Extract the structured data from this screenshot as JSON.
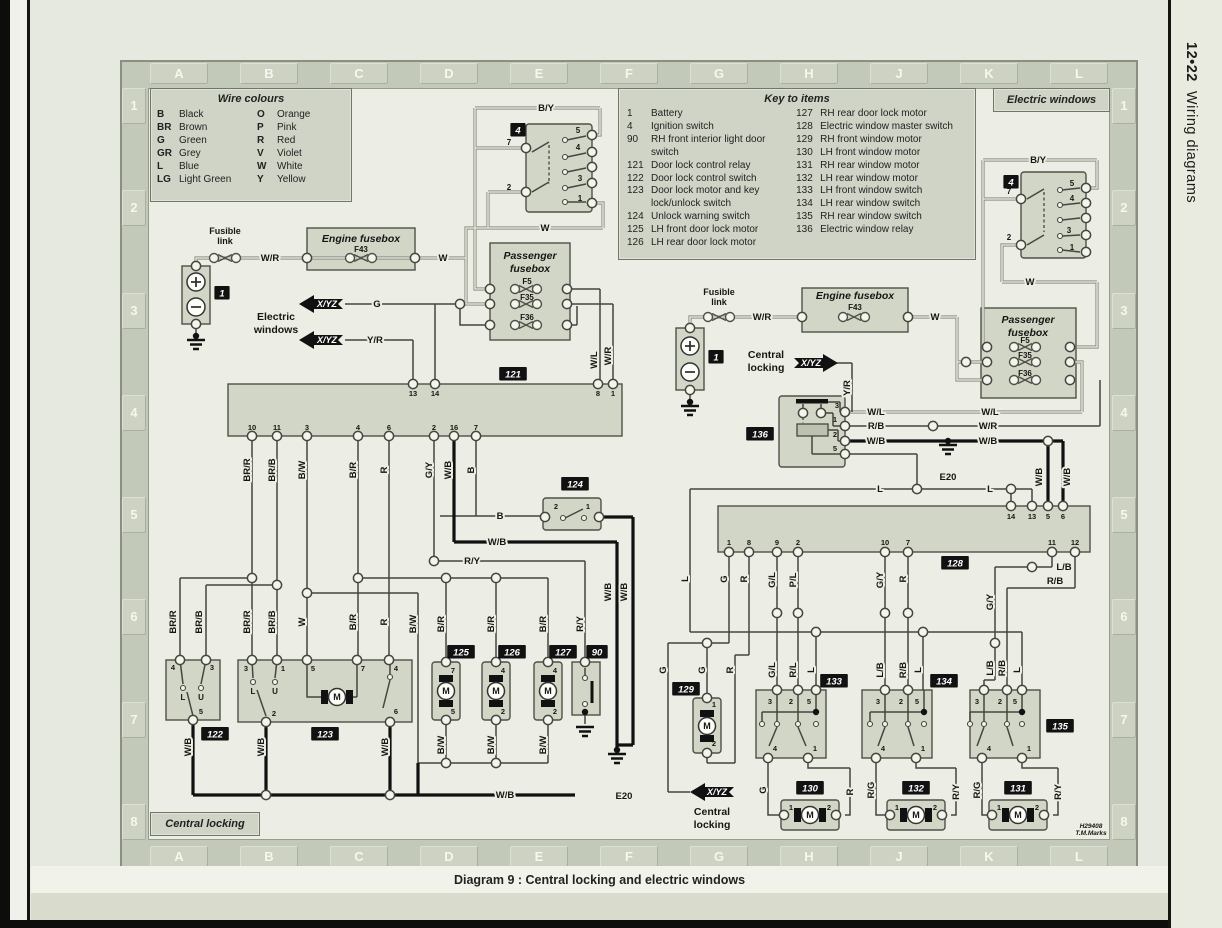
{
  "page": {
    "sidebar_page": "12•22",
    "sidebar_title": "Wiring diagrams",
    "caption": "Diagram 9 : Central locking and electric windows",
    "grid_letters": [
      "A",
      "B",
      "C",
      "D",
      "E",
      "F",
      "G",
      "H",
      "J",
      "K",
      "L"
    ],
    "grid_numbers": [
      "1",
      "2",
      "3",
      "4",
      "5",
      "6",
      "7",
      "8"
    ]
  },
  "tags": {
    "electric_windows": "Electric windows",
    "central_locking": "Central locking"
  },
  "wire_colours": {
    "title": "Wire colours",
    "entries": [
      {
        "c": "B",
        "n": "Black"
      },
      {
        "c": "O",
        "n": "Orange"
      },
      {
        "c": "BR",
        "n": "Brown"
      },
      {
        "c": "P",
        "n": "Pink"
      },
      {
        "c": "G",
        "n": "Green"
      },
      {
        "c": "R",
        "n": "Red"
      },
      {
        "c": "GR",
        "n": "Grey"
      },
      {
        "c": "V",
        "n": "Violet"
      },
      {
        "c": "L",
        "n": "Blue"
      },
      {
        "c": "W",
        "n": "White"
      },
      {
        "c": "LG",
        "n": "Light Green"
      },
      {
        "c": "Y",
        "n": "Yellow"
      }
    ]
  },
  "key_to_items": {
    "title": "Key to items",
    "left": [
      {
        "num": "1",
        "label": "Battery"
      },
      {
        "num": "4",
        "label": "Ignition switch"
      },
      {
        "num": "90",
        "label": "RH front interior light door switch"
      },
      {
        "num": "121",
        "label": "Door lock control relay"
      },
      {
        "num": "122",
        "label": "Door lock control switch"
      },
      {
        "num": "123",
        "label": "Door lock motor and key lock/unlock switch"
      },
      {
        "num": "124",
        "label": "Unlock warning switch"
      },
      {
        "num": "125",
        "label": "LH front door lock motor"
      },
      {
        "num": "126",
        "label": "LH rear door lock motor"
      }
    ],
    "right": [
      {
        "num": "127",
        "label": "RH rear door lock motor"
      },
      {
        "num": "128",
        "label": "Electric window master switch"
      },
      {
        "num": "129",
        "label": "RH front window motor"
      },
      {
        "num": "130",
        "label": "LH front window motor"
      },
      {
        "num": "131",
        "label": "RH rear window motor"
      },
      {
        "num": "132",
        "label": "LH rear window motor"
      },
      {
        "num": "133",
        "label": "LH front window switch"
      },
      {
        "num": "134",
        "label": "LH rear window switch"
      },
      {
        "num": "135",
        "label": "RH rear window switch"
      },
      {
        "num": "136",
        "label": "Electric window relay"
      }
    ]
  },
  "colors": {
    "badge_bg": "#111111",
    "wire_dark": "#3f413b",
    "inner_bg": "#ecede4",
    "box_fill": "#d2d6c6"
  },
  "svg": {
    "labels": [
      [
        546,
        111,
        "B/Y",
        "h"
      ],
      [
        545,
        231,
        "W",
        "h"
      ],
      [
        509,
        145,
        "7",
        "s8"
      ],
      [
        509,
        190,
        "2",
        "s8"
      ],
      [
        578,
        133,
        "5",
        "s8"
      ],
      [
        578,
        150,
        "4",
        "s8"
      ],
      [
        580,
        181,
        "3",
        "s8"
      ],
      [
        580,
        201,
        "1",
        "s8"
      ],
      [
        225,
        234,
        "Fusible",
        "s9"
      ],
      [
        225,
        244,
        "link",
        "s9"
      ],
      [
        270,
        261,
        "W/R",
        "h"
      ],
      [
        361,
        242,
        "Engine fusebox",
        "i10.5"
      ],
      [
        361,
        252,
        "F43",
        "s8"
      ],
      [
        443,
        261,
        "W",
        "h"
      ],
      [
        276,
        320,
        "Electric",
        "s10.5"
      ],
      [
        276,
        333,
        "windows",
        "s10.5"
      ],
      [
        327,
        307,
        "X/YZ",
        "wi9"
      ],
      [
        327,
        343,
        "X/YZ",
        "wi9"
      ],
      [
        377,
        307,
        "G",
        "h"
      ],
      [
        375,
        343,
        "Y/R",
        "h"
      ],
      [
        530,
        259,
        "Passenger",
        "i10.5"
      ],
      [
        530,
        272,
        "fusebox",
        "i10.5"
      ],
      [
        527,
        284,
        "F5",
        "s8"
      ],
      [
        527,
        300,
        "F35",
        "s8"
      ],
      [
        527,
        320,
        "F36",
        "s8"
      ],
      [
        597,
        360,
        "W/L",
        "rh"
      ],
      [
        611,
        356,
        "W/R",
        "rh"
      ],
      [
        413,
        396,
        "13",
        "s7.5"
      ],
      [
        435,
        396,
        "14",
        "s7.5"
      ],
      [
        598,
        396,
        "8",
        "s7.5"
      ],
      [
        613,
        396,
        "1",
        "s7.5"
      ],
      [
        252,
        430,
        "10",
        "s7.5"
      ],
      [
        277,
        430,
        "11",
        "s7.5"
      ],
      [
        307,
        430,
        "3",
        "s7.5"
      ],
      [
        358,
        430,
        "4",
        "s7.5"
      ],
      [
        389,
        430,
        "6",
        "s7.5"
      ],
      [
        434,
        430,
        "2",
        "s7.5"
      ],
      [
        454,
        430,
        "16",
        "s7.5"
      ],
      [
        476,
        430,
        "7",
        "s7.5"
      ],
      [
        250,
        470,
        "BR/R",
        "rh"
      ],
      [
        275,
        470,
        "BR/B",
        "rh"
      ],
      [
        305,
        470,
        "B/W",
        "rh"
      ],
      [
        356,
        470,
        "B/R",
        "rh"
      ],
      [
        387,
        470,
        "R",
        "rh"
      ],
      [
        432,
        470,
        "G/Y",
        "rh"
      ],
      [
        451,
        470,
        "W/B",
        "rh"
      ],
      [
        474,
        470,
        "B",
        "rh"
      ],
      [
        556,
        509,
        "2",
        "s7.5"
      ],
      [
        588,
        509,
        "1",
        "s7.5"
      ],
      [
        500,
        519,
        "B",
        "h"
      ],
      [
        497,
        545,
        "W/B",
        "h"
      ],
      [
        472,
        564,
        "R/Y",
        "h"
      ],
      [
        611,
        592,
        "W/B",
        "rh"
      ],
      [
        627,
        592,
        "W/B",
        "rh"
      ],
      [
        176,
        622,
        "BR/R",
        "rh"
      ],
      [
        202,
        622,
        "BR/B",
        "rh"
      ],
      [
        250,
        622,
        "BR/R",
        "rh"
      ],
      [
        275,
        622,
        "BR/B",
        "rh"
      ],
      [
        305,
        622,
        "W",
        "rh"
      ],
      [
        356,
        622,
        "B/R",
        "rh"
      ],
      [
        387,
        622,
        "R",
        "rh"
      ],
      [
        416,
        624,
        "B/W",
        "rh"
      ],
      [
        444,
        624,
        "B/R",
        "rh"
      ],
      [
        494,
        624,
        "B/R",
        "rh"
      ],
      [
        546,
        624,
        "B/R",
        "rh"
      ],
      [
        583,
        624,
        "R/Y",
        "rh"
      ],
      [
        173,
        670,
        "4",
        "s7.5"
      ],
      [
        212,
        670,
        "3",
        "s7.5"
      ],
      [
        183,
        700,
        "L",
        "s8"
      ],
      [
        201,
        700,
        "U",
        "s8"
      ],
      [
        201,
        714,
        "5",
        "s7.5"
      ],
      [
        191,
        747,
        "W/B",
        "rh"
      ],
      [
        246,
        671,
        "3",
        "s7.5"
      ],
      [
        283,
        671,
        "1",
        "s7.5"
      ],
      [
        313,
        671,
        "5",
        "s7.5"
      ],
      [
        363,
        671,
        "7",
        "s7.5"
      ],
      [
        396,
        671,
        "4",
        "s7.5"
      ],
      [
        253,
        694,
        "L",
        "s8"
      ],
      [
        275,
        694,
        "U",
        "s8"
      ],
      [
        274,
        716,
        "2",
        "s7.5"
      ],
      [
        337,
        700,
        "M",
        "s9"
      ],
      [
        396,
        714,
        "6",
        "s7.5"
      ],
      [
        264,
        747,
        "W/B",
        "rh"
      ],
      [
        388,
        747,
        "W/B",
        "rh"
      ],
      [
        453,
        673,
        "7",
        "s7.5"
      ],
      [
        453,
        714,
        "5",
        "s7.5"
      ],
      [
        446,
        694,
        "M",
        "s9"
      ],
      [
        503,
        673,
        "4",
        "s7.5"
      ],
      [
        503,
        714,
        "2",
        "s7.5"
      ],
      [
        496,
        694,
        "M",
        "s9"
      ],
      [
        555,
        673,
        "4",
        "s7.5"
      ],
      [
        555,
        714,
        "2",
        "s7.5"
      ],
      [
        548,
        694,
        "M",
        "s9"
      ],
      [
        444,
        745,
        "B/W",
        "rh"
      ],
      [
        494,
        745,
        "B/W",
        "rh"
      ],
      [
        546,
        745,
        "B/W",
        "rh"
      ],
      [
        505,
        798,
        "W/B",
        "h"
      ],
      [
        624,
        799,
        "E20",
        "h"
      ],
      [
        719,
        295,
        "Fusible",
        "s9"
      ],
      [
        719,
        305,
        "link",
        "s9"
      ],
      [
        762,
        320,
        "W/R",
        "h"
      ],
      [
        855,
        299,
        "Engine fusebox",
        "i10.5"
      ],
      [
        855,
        310,
        "F43",
        "s8"
      ],
      [
        935,
        320,
        "W",
        "h"
      ],
      [
        766,
        358,
        "Central",
        "s10.5"
      ],
      [
        766,
        371,
        "locking",
        "s10.5"
      ],
      [
        811,
        366,
        "X/YZ",
        "wi9"
      ],
      [
        850,
        388,
        "Y/R",
        "rh"
      ],
      [
        837,
        408,
        "3",
        "s7.5"
      ],
      [
        835,
        422,
        "1",
        "s7.5"
      ],
      [
        835,
        437,
        "2",
        "s7.5"
      ],
      [
        835,
        451,
        "5",
        "s7.5"
      ],
      [
        876,
        415,
        "W/L",
        "h"
      ],
      [
        990,
        415,
        "W/L",
        "h"
      ],
      [
        876,
        429,
        "R/B",
        "h"
      ],
      [
        988,
        429,
        "W/R",
        "h"
      ],
      [
        876,
        444,
        "W/B",
        "h"
      ],
      [
        988,
        444,
        "W/B",
        "h"
      ],
      [
        948,
        480,
        "E20",
        "h"
      ],
      [
        880,
        492,
        "L",
        "h"
      ],
      [
        990,
        492,
        "L",
        "h"
      ],
      [
        1042,
        477,
        "W/B",
        "rh"
      ],
      [
        1070,
        477,
        "W/B",
        "rh"
      ],
      [
        1009,
        194,
        "7",
        "s8"
      ],
      [
        1009,
        240,
        "2",
        "s8"
      ],
      [
        1072,
        186,
        "5",
        "s8"
      ],
      [
        1072,
        201,
        "4",
        "s8"
      ],
      [
        1069,
        233,
        "3",
        "s8"
      ],
      [
        1072,
        250,
        "1",
        "s8"
      ],
      [
        1038,
        163,
        "B/Y",
        "h"
      ],
      [
        1030,
        285,
        "W",
        "h"
      ],
      [
        1028,
        323,
        "Passenger",
        "i10.5"
      ],
      [
        1028,
        336,
        "fusebox",
        "i10.5"
      ],
      [
        1025,
        343,
        "F5",
        "s8"
      ],
      [
        1025,
        358,
        "F35",
        "s8"
      ],
      [
        1025,
        376,
        "F36",
        "s8"
      ],
      [
        1011,
        519,
        "14",
        "s7.5"
      ],
      [
        1032,
        519,
        "13",
        "s7.5"
      ],
      [
        1048,
        519,
        "5",
        "s7.5"
      ],
      [
        1063,
        519,
        "6",
        "s7.5"
      ],
      [
        729,
        545,
        "1",
        "s7.5"
      ],
      [
        749,
        545,
        "8",
        "s7.5"
      ],
      [
        777,
        545,
        "9",
        "s7.5"
      ],
      [
        798,
        545,
        "2",
        "s7.5"
      ],
      [
        885,
        545,
        "10",
        "s7.5"
      ],
      [
        908,
        545,
        "7",
        "s7.5"
      ],
      [
        1052,
        545,
        "11",
        "s7.5"
      ],
      [
        1075,
        545,
        "12",
        "s7.5"
      ],
      [
        727,
        579,
        "G",
        "rh"
      ],
      [
        747,
        579,
        "R",
        "rh"
      ],
      [
        775,
        580,
        "G/L",
        "rh"
      ],
      [
        796,
        580,
        "P/L",
        "rh"
      ],
      [
        883,
        580,
        "G/Y",
        "rh"
      ],
      [
        906,
        579,
        "R",
        "rh"
      ],
      [
        1064,
        570,
        "L/B",
        "h"
      ],
      [
        1055,
        584,
        "R/B",
        "h"
      ],
      [
        993,
        602,
        "G/Y",
        "rh"
      ],
      [
        993,
        668,
        "L/B",
        "rh"
      ],
      [
        1005,
        668,
        "R/B",
        "rh"
      ],
      [
        688,
        579,
        "L",
        "rh"
      ],
      [
        666,
        670,
        "G",
        "rh"
      ],
      [
        705,
        670,
        "G",
        "rh"
      ],
      [
        733,
        670,
        "R",
        "rh"
      ],
      [
        775,
        670,
        "G/L",
        "rh"
      ],
      [
        796,
        670,
        "R/L",
        "rh"
      ],
      [
        814,
        670,
        "L",
        "rh"
      ],
      [
        883,
        670,
        "L/B",
        "rh"
      ],
      [
        906,
        670,
        "R/B",
        "rh"
      ],
      [
        921,
        670,
        "L",
        "rh"
      ],
      [
        1020,
        670,
        "L",
        "rh"
      ],
      [
        714,
        707,
        "1",
        "s7.5"
      ],
      [
        714,
        746,
        "2",
        "s7.5"
      ],
      [
        707,
        729,
        "M",
        "s9"
      ],
      [
        770,
        704,
        "3",
        "s7.5"
      ],
      [
        791,
        704,
        "2",
        "s7.5"
      ],
      [
        809,
        704,
        "5",
        "s7.5"
      ],
      [
        775,
        751,
        "4",
        "s7.5"
      ],
      [
        815,
        751,
        "1",
        "s7.5"
      ],
      [
        878,
        704,
        "3",
        "s7.5"
      ],
      [
        901,
        704,
        "2",
        "s7.5"
      ],
      [
        917,
        704,
        "5",
        "s7.5"
      ],
      [
        883,
        751,
        "4",
        "s7.5"
      ],
      [
        923,
        751,
        "1",
        "s7.5"
      ],
      [
        977,
        704,
        "3",
        "s7.5"
      ],
      [
        1000,
        704,
        "2",
        "s7.5"
      ],
      [
        1015,
        704,
        "5",
        "s7.5"
      ],
      [
        989,
        751,
        "4",
        "s7.5"
      ],
      [
        1029,
        751,
        "1",
        "s7.5"
      ],
      [
        766,
        790,
        "G",
        "rh"
      ],
      [
        853,
        792,
        "R",
        "rh"
      ],
      [
        874,
        790,
        "R/G",
        "rh"
      ],
      [
        959,
        792,
        "R/Y",
        "rh"
      ],
      [
        980,
        790,
        "R/G",
        "rh"
      ],
      [
        1061,
        792,
        "R/Y",
        "rh"
      ],
      [
        717,
        795,
        "X/YZ",
        "wi9"
      ],
      [
        712,
        815,
        "Central",
        "s10.5"
      ],
      [
        712,
        828,
        "locking",
        "s10.5"
      ],
      [
        791,
        810,
        "1",
        "s7.5"
      ],
      [
        829,
        810,
        "2",
        "s7.5"
      ],
      [
        810,
        818,
        "M",
        "s9"
      ],
      [
        897,
        810,
        "1",
        "s7.5"
      ],
      [
        935,
        810,
        "2",
        "s7.5"
      ],
      [
        916,
        818,
        "M",
        "s9"
      ],
      [
        999,
        810,
        "1",
        "s7.5"
      ],
      [
        1037,
        810,
        "2",
        "s7.5"
      ],
      [
        1018,
        818,
        "M",
        "s9"
      ],
      [
        1091,
        828,
        "H29408",
        "i6.5"
      ],
      [
        1091,
        835,
        "T.M.Marks",
        "i6.5"
      ]
    ],
    "badges": [
      [
        518,
        130,
        "4"
      ],
      [
        222,
        293,
        "1"
      ],
      [
        513,
        374,
        "121"
      ],
      [
        575,
        484,
        "124"
      ],
      [
        215,
        734,
        "122"
      ],
      [
        325,
        734,
        "123"
      ],
      [
        461,
        652,
        "125"
      ],
      [
        512,
        652,
        "126"
      ],
      [
        563,
        652,
        "127"
      ],
      [
        597,
        652,
        "90"
      ],
      [
        1011,
        182,
        "4"
      ],
      [
        716,
        357,
        "1"
      ],
      [
        760,
        434,
        "136"
      ],
      [
        955,
        563,
        "128"
      ],
      [
        686,
        689,
        "129"
      ],
      [
        834,
        681,
        "133"
      ],
      [
        944,
        681,
        "134"
      ],
      [
        1060,
        726,
        "135"
      ],
      [
        810,
        788,
        "130"
      ],
      [
        916,
        788,
        "132"
      ],
      [
        1018,
        788,
        "131"
      ]
    ]
  }
}
